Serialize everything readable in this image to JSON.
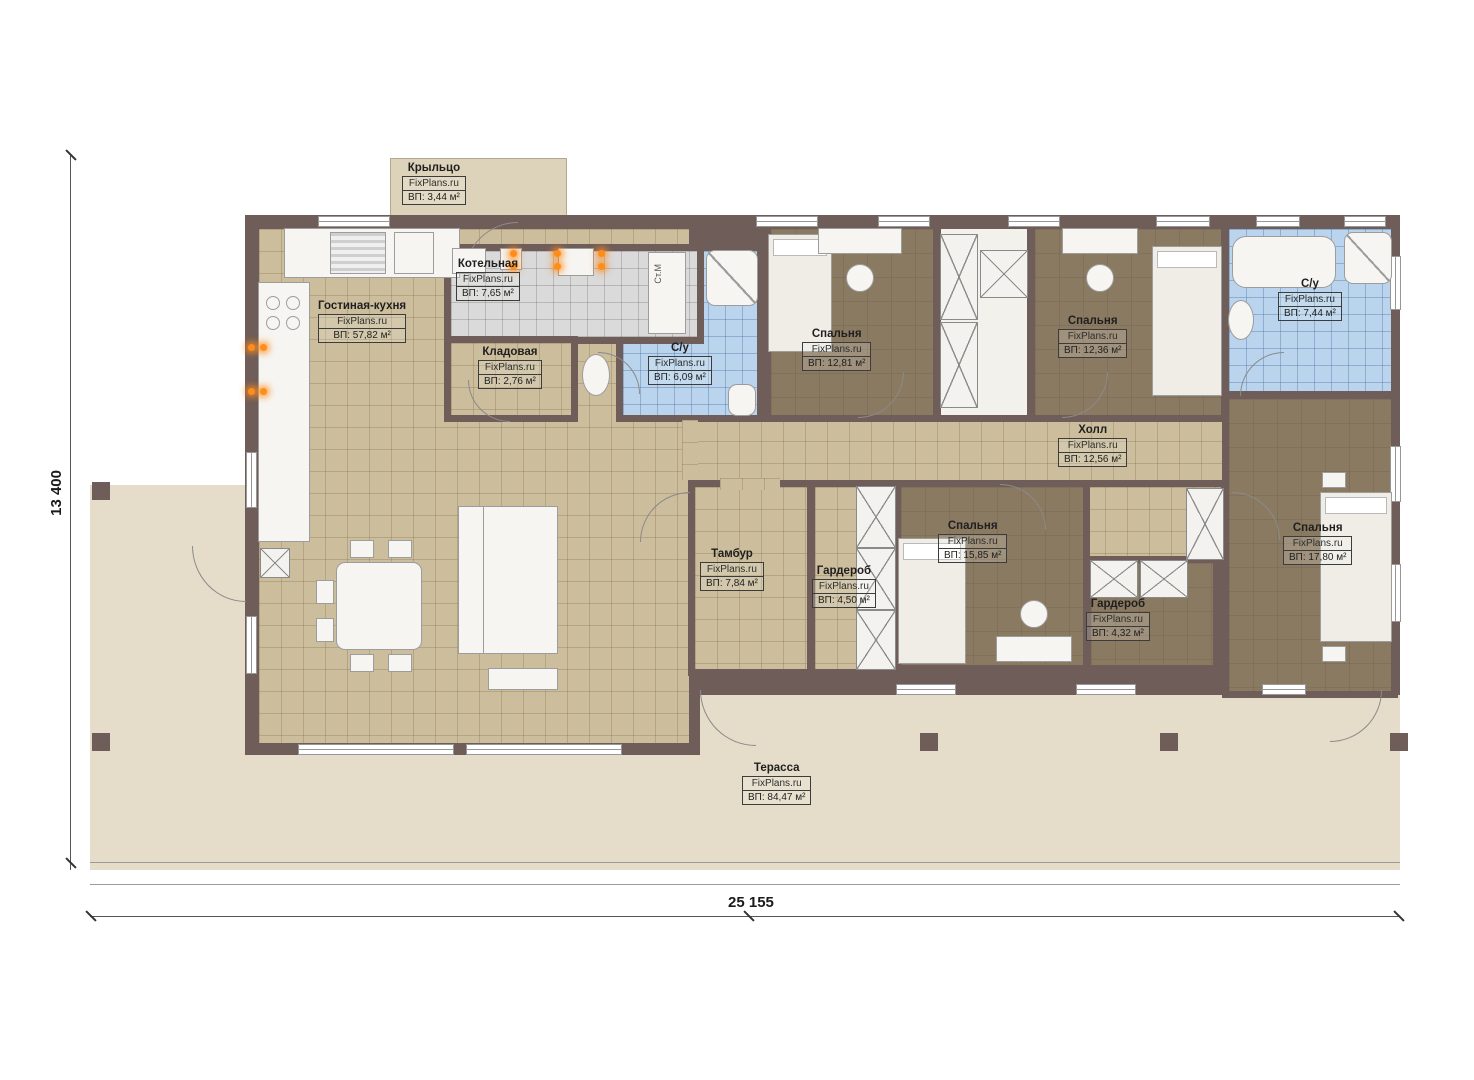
{
  "site": "FixPlans.ru",
  "dimensions": {
    "width_label": "25 155",
    "height_label": "13 400"
  },
  "fixtures": {
    "washing_machine": "Ст.М"
  },
  "colors": {
    "wall": "#6f5d59",
    "floor_beige": "#ccbd9d",
    "floor_brown": "#8b7a62",
    "tile_blue": "#b9d4ec",
    "tile_gray": "#dadada",
    "terrace": "#e5dcc9",
    "accent_lamp": "#ff8d1a"
  },
  "labels": {
    "porch": {
      "name": "Крыльцо",
      "area": "ВП: 3,44 м²"
    },
    "boiler": {
      "name": "Котельная",
      "area": "ВП: 7,65 м²"
    },
    "living": {
      "name": "Гостиная-кухня",
      "area": "ВП: 57,82 м²"
    },
    "storage": {
      "name": "Кладовая",
      "area": "ВП: 2,76 м²"
    },
    "su1": {
      "name": "С/у",
      "area": "ВП: 6,09 м²"
    },
    "bedroom1": {
      "name": "Спальня",
      "area": "ВП: 12,81 м²"
    },
    "bedroom2": {
      "name": "Спальня",
      "area": "ВП: 12,36 м²"
    },
    "su2": {
      "name": "С/у",
      "area": "ВП: 7,44 м²"
    },
    "hall": {
      "name": "Холл",
      "area": "ВП: 12,56 м²"
    },
    "tambour": {
      "name": "Тамбур",
      "area": "ВП: 7,84 м²"
    },
    "wardrobe1": {
      "name": "Гардероб",
      "area": "ВП: 4,50 м²"
    },
    "bedroom3": {
      "name": "Спальня",
      "area": "ВП: 15,85 м²"
    },
    "wardrobe2": {
      "name": "Гардероб",
      "area": "ВП: 4,32 м²"
    },
    "bedroom4": {
      "name": "Спальня",
      "area": "ВП: 17,80 м²"
    },
    "terrace": {
      "name": "Терасса",
      "area": "ВП: 84,47 м²"
    }
  }
}
